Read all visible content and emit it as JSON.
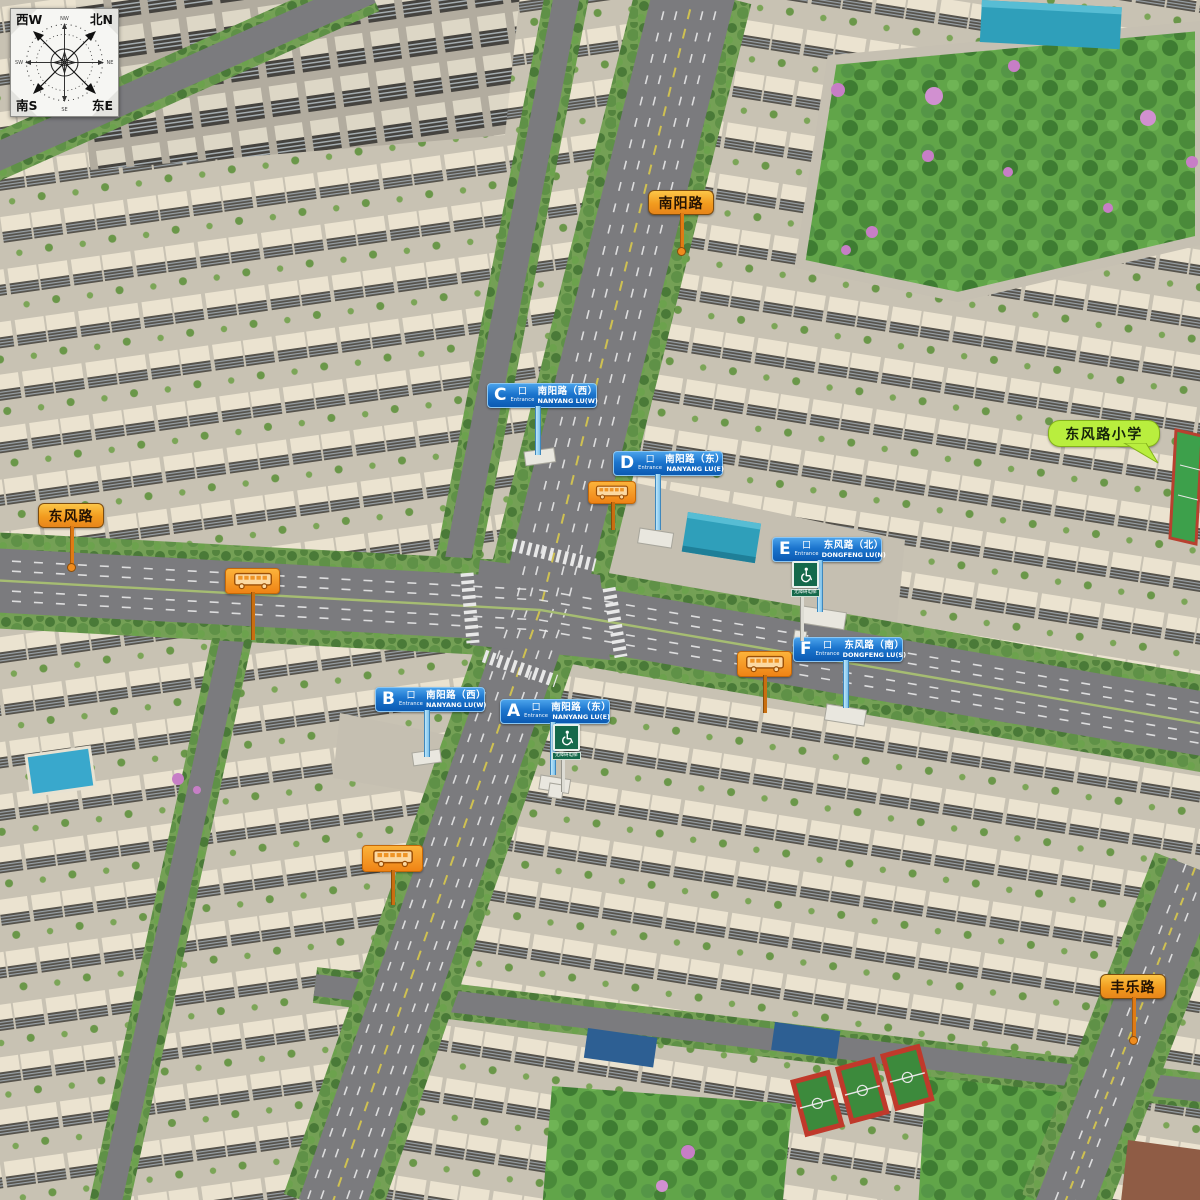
{
  "compass": {
    "corner_nw": "西W",
    "corner_ne": "北N",
    "corner_sw": "南S",
    "corner_se": "东E",
    "mid_top": "NW",
    "mid_right": "NE",
    "mid_bottom": "SE",
    "mid_left": "SW"
  },
  "roads": {
    "nanyang": "南阳路",
    "dongfeng": "东风路",
    "fengle": "丰乐路"
  },
  "school_label": "东风路小学",
  "gate_char": "口",
  "entrance_word": "Entrance",
  "entrances": [
    {
      "letter": "A",
      "cn": "南阳路（东）",
      "en": "NANYANG LU(E)"
    },
    {
      "letter": "B",
      "cn": "南阳路（西）",
      "en": "NANYANG LU(W)"
    },
    {
      "letter": "C",
      "cn": "南阳路（西）",
      "en": "NANYANG LU(W)"
    },
    {
      "letter": "D",
      "cn": "南阳路（东）",
      "en": "NANYANG LU(E)"
    },
    {
      "letter": "E",
      "cn": "东风路（北）",
      "en": "DONGFENG LU(N)"
    },
    {
      "letter": "F",
      "cn": "东风路（南）",
      "en": "DONGFENG LU(S)"
    }
  ],
  "accessibility_label": "无障碍电梯",
  "colors": {
    "entrance_blue": "#1b74cd",
    "road_label_orange": "#f29b1e",
    "bus_orange": "#ef8315",
    "school_green": "#b9ee3e",
    "accessibility_green": "#15694b",
    "park_green": "#61a549",
    "asphalt": "#7b7b7e"
  }
}
